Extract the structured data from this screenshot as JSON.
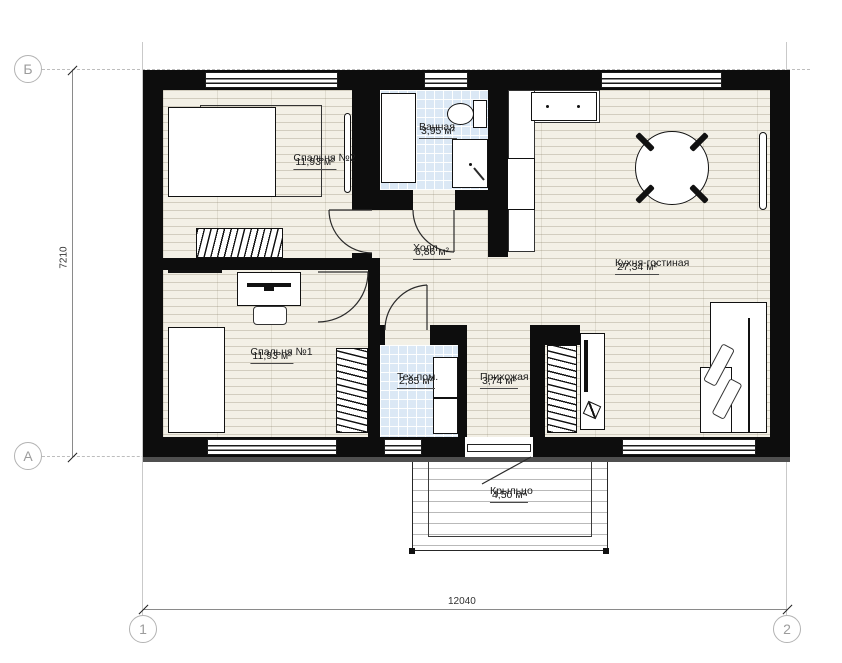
{
  "drawing": {
    "type": "floor-plan",
    "rooms": [
      {
        "name": "Спальня №2",
        "area": "11,93 м²"
      },
      {
        "name": "Ванная",
        "area": "3,95 м²"
      },
      {
        "name": "Холл",
        "area": "6,86 м²"
      },
      {
        "name": "Кухня-гостиная",
        "area": "27,34 м²"
      },
      {
        "name": "Спальня №1",
        "area": "11,93 м²"
      },
      {
        "name": "Тех.пом.",
        "area": "2,85 м²"
      },
      {
        "name": "Прихожая",
        "area": "3,74 м²"
      },
      {
        "name": "Крыльцо",
        "area": "4,50 м²"
      }
    ],
    "axes": {
      "row_top": "Б",
      "row_bottom": "А",
      "col_left": "1",
      "col_right": "2"
    },
    "dimensions": {
      "overall_width": "12040",
      "overall_height": "7210"
    },
    "colors": {
      "wall": "#0d0d0d",
      "wood_floor": "#f3f0e6",
      "tile_floor": "#dbe8f5",
      "axis_gray": "#b3b3b3"
    }
  }
}
